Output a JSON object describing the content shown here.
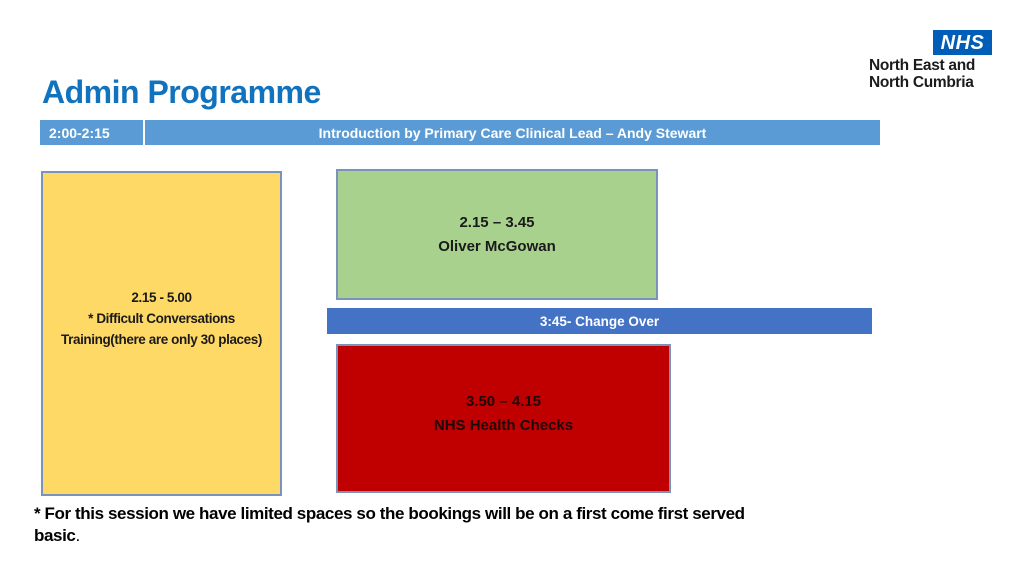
{
  "slide": {
    "title": "Admin Programme",
    "logo": {
      "nhs": "NHS",
      "line1": "North East and",
      "line2": "North Cumbria"
    },
    "header_row": {
      "time": "2:00-2:15",
      "session": "Introduction by Primary Care Clinical Lead – Andy Stewart"
    },
    "yellow_box": {
      "lines": [
        "2.15 - 5.00",
        "* Difficult Conversations",
        "Training(there are only 30 places)"
      ]
    },
    "green_box": {
      "lines": [
        "2.15 – 3.45",
        "Oliver McGowan"
      ]
    },
    "changeover_bar": {
      "label": "3:45- Change Over"
    },
    "red_box": {
      "lines": [
        "3.50 – 4.15",
        "NHS Health Checks"
      ]
    },
    "footnote": {
      "line1": "* For this session we have limited spaces so the bookings will be on a first come first served",
      "line2_bold": "basic",
      "line2_tail": "."
    },
    "colors": {
      "title_blue": "#1173BE",
      "header_bar_blue": "#5B9BD5",
      "changeover_blue": "#4472C4",
      "yellow_fill": "#FFD966",
      "green_fill": "#A9D18E",
      "red_fill": "#C00000",
      "box_border": "#7A93BD",
      "nhs_blue": "#005EB8"
    }
  }
}
